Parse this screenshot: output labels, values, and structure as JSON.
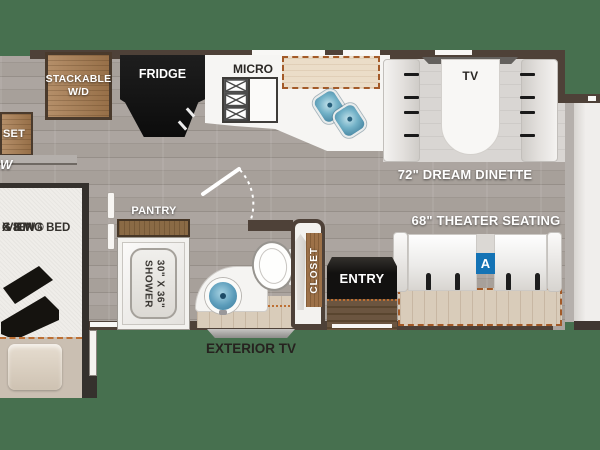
{
  "colors": {
    "background": "#47704f",
    "wall": "#4e4138",
    "wood": "#a87c50",
    "slide_dash": "#a35a28",
    "badge_blue": "#1473b5",
    "sink_blue": "#5b9cba"
  },
  "labels": {
    "stackable_line1": "STACKABLE",
    "stackable_line2": "W/D",
    "fridge": "FRIDGE",
    "micro": "MICRO",
    "dinette_tv": "TV",
    "dinette": "72\" DREAM DINETTE",
    "theater": "68\" THEATER SEATING",
    "badge": "A",
    "pantry": "PANTRY",
    "shower_line1": "SHOWER",
    "shower_line2": "30\" X 36\"",
    "closet": "CLOSET",
    "entry": "ENTRY",
    "exterior_tv": "EXTERIOR TV",
    "closet_left_fragment": "SET",
    "w_fragment": "W",
    "bed_line1": "-VIEW®",
    "bed_line2": "G KING BED",
    "bed_line3": "X 80\""
  }
}
